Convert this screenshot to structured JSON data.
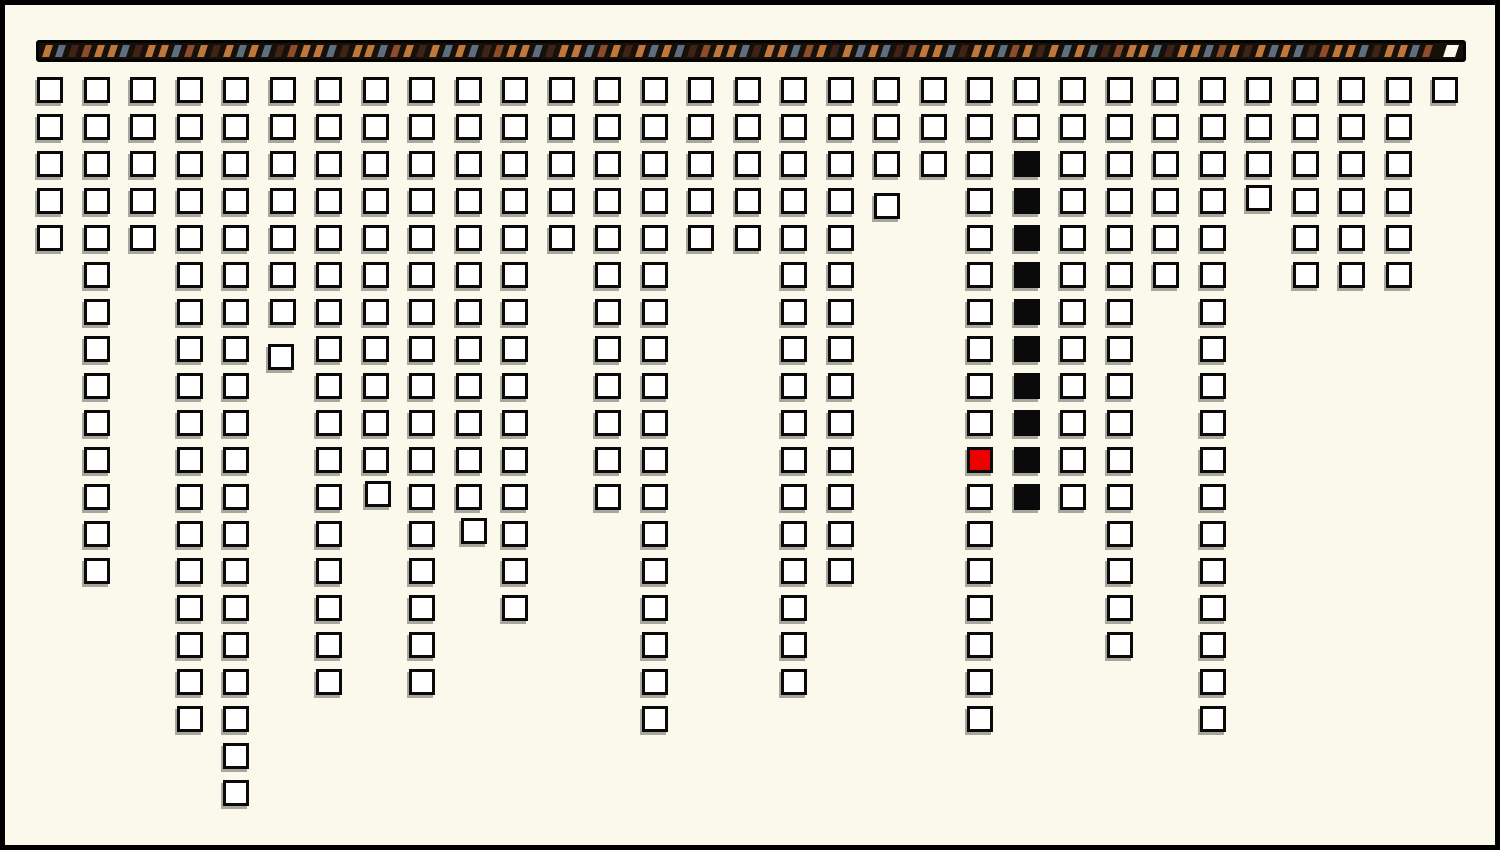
{
  "canvas": {
    "width": 1500,
    "height": 850,
    "background": "#faf9ec",
    "frame_color": "#000000",
    "frame_width": 5
  },
  "ribbon": {
    "x": 36,
    "y": 40,
    "width": 1430,
    "height": 22,
    "background": "#16100b",
    "outline_color": "#060402",
    "stripe_width": 7,
    "stripe_pitch": 12.9,
    "stripe_start_x": 5,
    "stripe_skew_deg": -18,
    "palette": {
      "tan": "#c0773c",
      "slate": "#5d6f7f",
      "dark": "#3f2317",
      "rust": "#8e4c2a",
      "cap": "#faf9ec"
    },
    "pattern": [
      "tan",
      "slate",
      "dark",
      "rust",
      "tan",
      "tan",
      "slate",
      "dark",
      "tan",
      "tan",
      "slate",
      "rust",
      "tan",
      "dark",
      "tan",
      "slate"
    ],
    "end_cap": {
      "x": 1406,
      "width": 12,
      "color": "cap"
    }
  },
  "grid": {
    "origin_x": 37,
    "origin_y": 77,
    "col_pitch": 46.5,
    "row_pitch": 37,
    "cell_size": 26,
    "cell_border_color": "#0a0a0a",
    "cell_fill": "#ffffff",
    "black_fill": "#0a0a0a",
    "red_fill": "#ee0000",
    "shadow_color": "rgba(0,0,0,0.33)",
    "column_heights": [
      5,
      14,
      5,
      18,
      20,
      8,
      17,
      12,
      17,
      13,
      15,
      5,
      12,
      18,
      5,
      5,
      17,
      14,
      4,
      3,
      18,
      12,
      12,
      16,
      6,
      18,
      4,
      6,
      6,
      6,
      1
    ],
    "red_cells": [
      {
        "col": 20,
        "row": 11
      }
    ],
    "black_runs": [
      {
        "col": 21,
        "from_row": 3,
        "to_row": 12
      }
    ],
    "jitter": [
      {
        "col": 5,
        "row": 8,
        "dx": -2,
        "dy": 8
      },
      {
        "col": 18,
        "row": 4,
        "dx": 0,
        "dy": 5
      },
      {
        "col": 7,
        "row": 12,
        "dx": 2,
        "dy": -3
      },
      {
        "col": 9,
        "row": 13,
        "dx": 5,
        "dy": -3
      },
      {
        "col": 26,
        "row": 4,
        "dx": 0,
        "dy": -3
      }
    ]
  },
  "chart_data": {
    "type": "bar",
    "title": "",
    "xlabel": "",
    "ylabel": "",
    "orientation": "columns hang downward from top edge, each bar drawn as a stack of outlined unit squares",
    "unit": "squares",
    "categories": [
      "1",
      "2",
      "3",
      "4",
      "5",
      "6",
      "7",
      "8",
      "9",
      "10",
      "11",
      "12",
      "13",
      "14",
      "15",
      "16",
      "17",
      "18",
      "19",
      "20",
      "21",
      "22",
      "23",
      "24",
      "25",
      "26",
      "27",
      "28",
      "29",
      "30",
      "31"
    ],
    "values": [
      5,
      14,
      5,
      18,
      20,
      8,
      17,
      12,
      17,
      13,
      15,
      5,
      12,
      18,
      5,
      5,
      17,
      14,
      4,
      3,
      18,
      12,
      12,
      16,
      6,
      18,
      4,
      6,
      6,
      6,
      1
    ],
    "ylim": [
      0,
      20
    ],
    "grid_lines": "off",
    "legend": "none",
    "axes_labels": "none",
    "annotations": [
      {
        "label": "red highlighted square",
        "column": 21,
        "row": 11,
        "color": "#ee0000"
      },
      {
        "label": "black filled squares",
        "column": 22,
        "rows": [
          3,
          4,
          5,
          6,
          7,
          8,
          9,
          10,
          11,
          12
        ],
        "color": "#0a0a0a"
      },
      {
        "label": "striped ribbon header",
        "colors": [
          "#c0773c",
          "#5d6f7f",
          "#3f2317",
          "#8e4c2a"
        ],
        "position": "top, full width"
      }
    ]
  }
}
